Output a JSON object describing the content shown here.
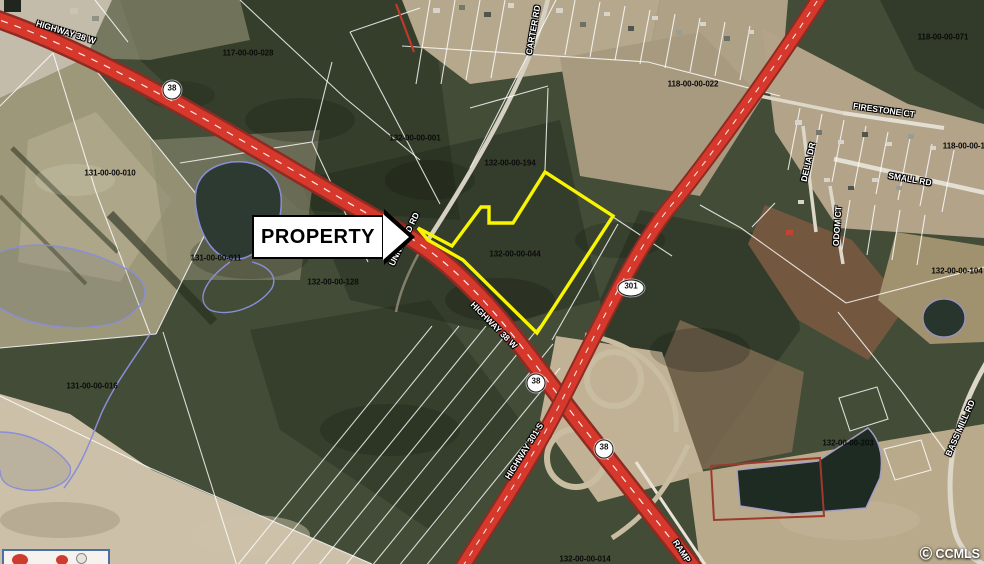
{
  "map": {
    "property_arrow_label": "PROPERTY",
    "watermark": "Ⓒ CCMLS",
    "colors": {
      "highway_red": "#d6392c",
      "highway_edge": "#8f2b22",
      "property_outline_yellow": "#f9f400",
      "water_outline_blue": "#8a8ed8",
      "parcel_line_white": "#ffffff",
      "minor_road_gray": "#d6d0c2",
      "ramp_tan": "#c9bda1",
      "pond_dark": "#22302a",
      "red_parcel_outline": "#9e3a2c",
      "parcel_label_black": "#0b0b0b",
      "road_label_white": "#ffffff"
    },
    "parcel_labels": [
      {
        "text": "117-00-00-028",
        "x": 248,
        "y": 53
      },
      {
        "text": "132-00-00-001",
        "x": 415,
        "y": 138
      },
      {
        "text": "132-00-00-194",
        "x": 510,
        "y": 163
      },
      {
        "text": "118-00-00-022",
        "x": 693,
        "y": 84
      },
      {
        "text": "118-00-00-071",
        "x": 943,
        "y": 37
      },
      {
        "text": "118-00-00-12",
        "x": 966,
        "y": 146
      },
      {
        "text": "131-00-00-010",
        "x": 110,
        "y": 173
      },
      {
        "text": "131-00-00-011",
        "x": 216,
        "y": 258
      },
      {
        "text": "132-00-00-128",
        "x": 333,
        "y": 282
      },
      {
        "text": "132-00-00-044",
        "x": 515,
        "y": 254
      },
      {
        "text": "132-00-00-104",
        "x": 957,
        "y": 271
      },
      {
        "text": "131-00-00-016",
        "x": 92,
        "y": 386
      },
      {
        "text": "132-00-00-203",
        "x": 848,
        "y": 443
      },
      {
        "text": "132-00-00-014",
        "x": 585,
        "y": 559
      }
    ],
    "road_labels": [
      {
        "text": "HIGHWAY 38 W",
        "x": 66,
        "y": 32,
        "angle": 17
      },
      {
        "text": "CARTER RD",
        "x": 533,
        "y": 30,
        "angle": -80
      },
      {
        "text": "UNNAMED RD",
        "x": 404,
        "y": 239,
        "angle": -64
      },
      {
        "text": "HIGHWAY 38 W",
        "x": 494,
        "y": 325,
        "angle": 45
      },
      {
        "text": "HIGHWAY 301 S",
        "x": 524,
        "y": 451,
        "angle": -58
      },
      {
        "text": "RAMP",
        "x": 682,
        "y": 551,
        "angle": 57
      },
      {
        "text": "FIRESTONE CT",
        "x": 884,
        "y": 110,
        "angle": 8
      },
      {
        "text": "SMALL RD",
        "x": 910,
        "y": 179,
        "angle": 10
      },
      {
        "text": "DELIA DR",
        "x": 808,
        "y": 162,
        "angle": -77
      },
      {
        "text": "ODOM CT",
        "x": 837,
        "y": 226,
        "angle": -86
      },
      {
        "text": "BASS MILL RD",
        "x": 960,
        "y": 428,
        "angle": -66
      }
    ],
    "route_shields": [
      {
        "label": "38",
        "x": 172,
        "y": 90,
        "shape": "circle"
      },
      {
        "label": "38",
        "x": 536,
        "y": 383,
        "shape": "circle"
      },
      {
        "label": "38",
        "x": 604,
        "y": 449,
        "shape": "circle"
      },
      {
        "label": "301",
        "x": 631,
        "y": 288,
        "shape": "oval"
      }
    ]
  }
}
